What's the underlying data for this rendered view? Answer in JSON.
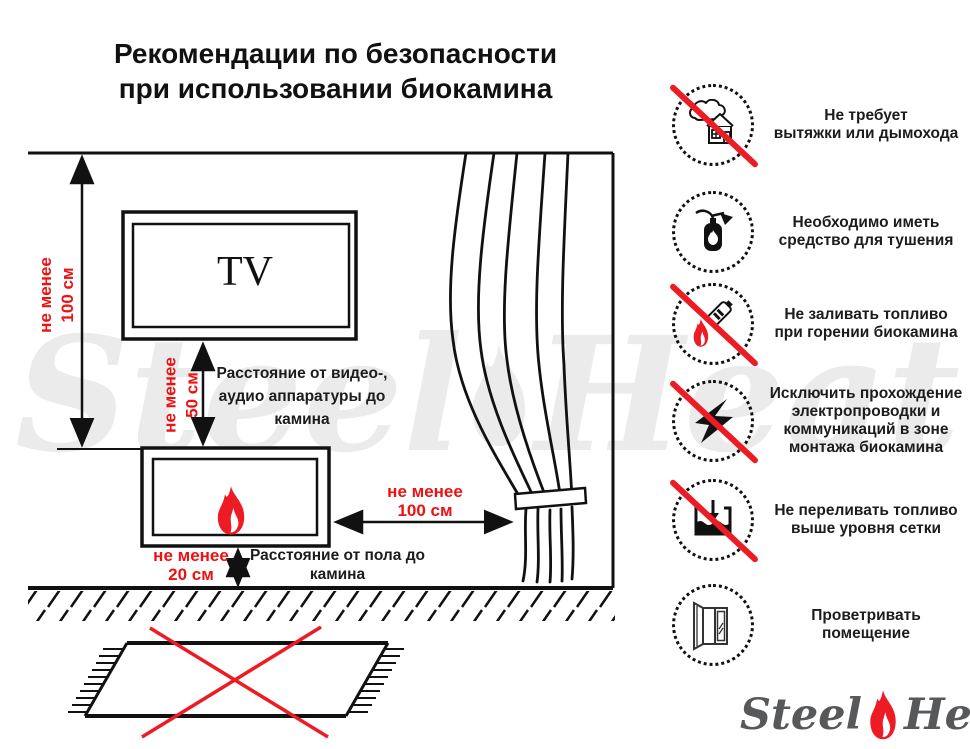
{
  "title": {
    "text": "Рекомендации по безопасности\nпри использовании биокамина"
  },
  "colors": {
    "accent_red": "#ed1c24",
    "dim_red": "#ed1111",
    "line_black": "#111111",
    "watermark_gray": "#ebebeb",
    "logo_gray": "#57585a"
  },
  "diagram": {
    "tv_label": "TV",
    "dim_ceiling_to_fireplace": "не менее\n100 см",
    "dim_tv_to_fireplace": "не менее\n50 см",
    "label_tv_distance": "Расстояние от видео-,\nаудио аппаратуры до\nкамина",
    "dim_fireplace_to_curtain": "не менее\n100 см",
    "dim_floor_to_fireplace": "не менее\n20 см",
    "label_floor_distance": "Расстояние от пола до\nкамина"
  },
  "safety_items": [
    {
      "icon": "no-chimney-icon",
      "prohibited": true,
      "text": "Не требует\nвытяжки или дымохода"
    },
    {
      "icon": "fire-extinguisher-icon",
      "prohibited": false,
      "text": "Необходимо иметь\nсредство для тушения"
    },
    {
      "icon": "no-refuel-while-burning-icon",
      "prohibited": true,
      "text": "Не заливать топливо\nпри горении биокамина"
    },
    {
      "icon": "no-wiring-icon",
      "prohibited": true,
      "text": "Исключить прохождение\nэлектропроводки и\nкоммуникаций в зоне\nмонтажа биокамина"
    },
    {
      "icon": "no-overfill-icon",
      "prohibited": true,
      "text": "Не переливать топливо\nвыше уровня сетки"
    },
    {
      "icon": "ventilate-icon",
      "prohibited": false,
      "text": "Проветривать\nпомещение"
    }
  ],
  "watermark": {
    "part1": "Steel",
    "part2": "Heat"
  },
  "logo": {
    "part1": "Steel",
    "part2": "Heat"
  }
}
